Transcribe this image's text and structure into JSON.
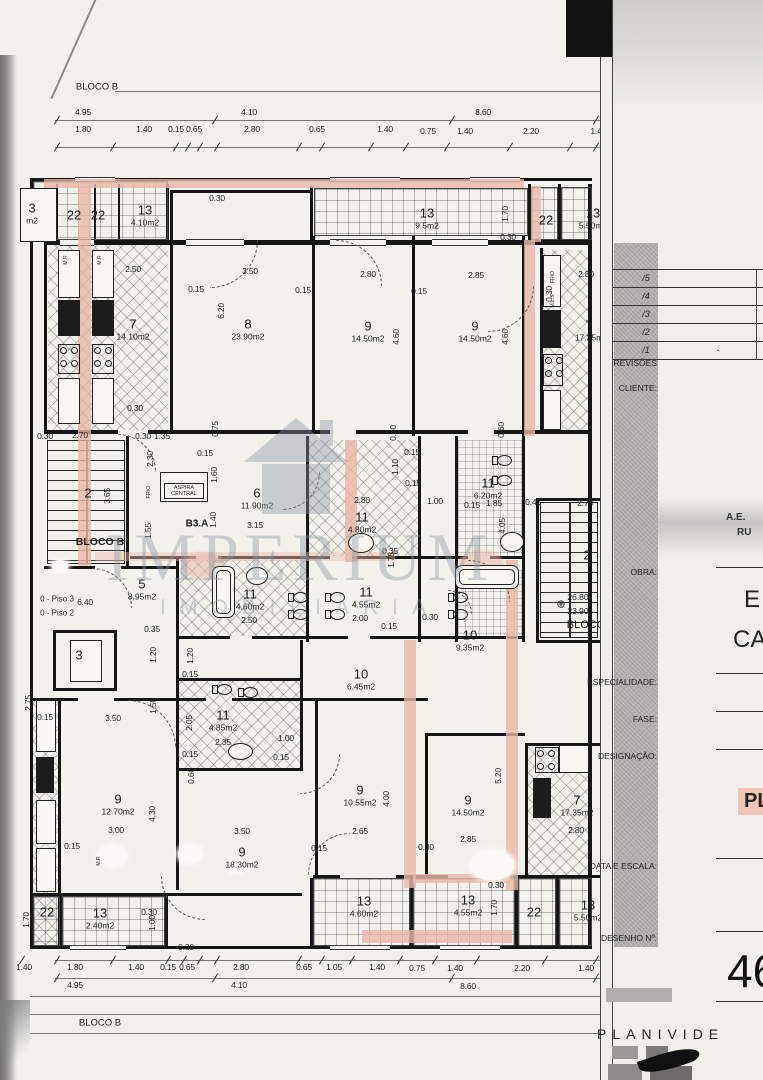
{
  "page": {
    "bloco_label_top": "BLOCO B",
    "bloco_label_bottom": "BLOCO B"
  },
  "watermark": {
    "brand": "IMPERIUM",
    "tagline": "IMOBILIÁRIA"
  },
  "colors": {
    "wall_highlight": "#e8b7a6",
    "designation_highlight": "#f2c6b6",
    "paper": "#f2f1ec",
    "ink": "#1b1b1b"
  },
  "plan": {
    "dim_labels": [
      {
        "t": "4.95",
        "x": 83,
        "y": 112
      },
      {
        "t": "4.10",
        "x": 249,
        "y": 112
      },
      {
        "t": "8.60",
        "x": 483,
        "y": 112
      },
      {
        "t": "1.80",
        "x": 83,
        "y": 129
      },
      {
        "t": "1.40",
        "x": 144,
        "y": 129
      },
      {
        "t": "0.15",
        "x": 176,
        "y": 129
      },
      {
        "t": "0.65",
        "x": 194,
        "y": 129
      },
      {
        "t": "2.80",
        "x": 252,
        "y": 129
      },
      {
        "t": "0.65",
        "x": 317,
        "y": 129
      },
      {
        "t": "1.40",
        "x": 385,
        "y": 129
      },
      {
        "t": "0.75",
        "x": 428,
        "y": 131
      },
      {
        "t": "1.40",
        "x": 465,
        "y": 131
      },
      {
        "t": "2.20",
        "x": 531,
        "y": 131
      },
      {
        "t": "1.4",
        "x": 596,
        "y": 131
      },
      {
        "t": "0.30",
        "x": 217,
        "y": 198
      },
      {
        "t": "1.70",
        "x": 505,
        "y": 214,
        "v": 1
      },
      {
        "t": "0.30",
        "x": 508,
        "y": 237
      },
      {
        "t": "2.50",
        "x": 133,
        "y": 269
      },
      {
        "t": "3.50",
        "x": 250,
        "y": 271
      },
      {
        "t": "0.15",
        "x": 196,
        "y": 289
      },
      {
        "t": "6.20",
        "x": 221,
        "y": 311,
        "v": 1
      },
      {
        "t": "0.30",
        "x": 135,
        "y": 408
      },
      {
        "t": "2.80",
        "x": 368,
        "y": 274
      },
      {
        "t": "0.15",
        "x": 303,
        "y": 290
      },
      {
        "t": "4.60",
        "x": 396,
        "y": 337,
        "v": 1
      },
      {
        "t": "2.85",
        "x": 476,
        "y": 275
      },
      {
        "t": "0.15",
        "x": 419,
        "y": 291
      },
      {
        "t": "4.60",
        "x": 505,
        "y": 337,
        "v": 1
      },
      {
        "t": "2.80",
        "x": 586,
        "y": 274
      },
      {
        "t": "0.30",
        "x": 549,
        "y": 294,
        "v": 1
      },
      {
        "t": "0.30",
        "x": 45,
        "y": 436
      },
      {
        "t": "2.70",
        "x": 80,
        "y": 435
      },
      {
        "t": "0.30",
        "x": 143,
        "y": 436
      },
      {
        "t": "1.35",
        "x": 162,
        "y": 436
      },
      {
        "t": "0.75",
        "x": 215,
        "y": 429,
        "v": 1
      },
      {
        "t": "0.60",
        "x": 393,
        "y": 433,
        "v": 1
      },
      {
        "t": "0.60",
        "x": 501,
        "y": 430,
        "v": 1
      },
      {
        "t": "0.15",
        "x": 205,
        "y": 453
      },
      {
        "t": "2.30",
        "x": 150,
        "y": 459,
        "v": 1
      },
      {
        "t": "1.60",
        "x": 214,
        "y": 475,
        "v": 1
      },
      {
        "t": "3.65",
        "x": 107,
        "y": 496,
        "v": 1
      },
      {
        "t": "0.15",
        "x": 412,
        "y": 452
      },
      {
        "t": "1.10",
        "x": 395,
        "y": 467,
        "v": 1
      },
      {
        "t": "0.15",
        "x": 413,
        "y": 483
      },
      {
        "t": "2.80",
        "x": 362,
        "y": 500
      },
      {
        "t": "1.00",
        "x": 435,
        "y": 501
      },
      {
        "t": "0.15",
        "x": 472,
        "y": 505
      },
      {
        "t": "1.85",
        "x": 494,
        "y": 503
      },
      {
        "t": "4.05",
        "x": 502,
        "y": 526,
        "v": 1
      },
      {
        "t": "0.45",
        "x": 533,
        "y": 502
      },
      {
        "t": "2.70",
        "x": 585,
        "y": 503
      },
      {
        "t": "3.15",
        "x": 255,
        "y": 525
      },
      {
        "t": "1.40",
        "x": 213,
        "y": 520,
        "v": 1
      },
      {
        "t": "1.55",
        "x": 148,
        "y": 531,
        "v": 1
      },
      {
        "t": "1.75",
        "x": 391,
        "y": 560,
        "v": 1
      },
      {
        "t": "0.35",
        "x": 390,
        "y": 551
      },
      {
        "t": "6.40",
        "x": 85,
        "y": 602
      },
      {
        "t": "0.35",
        "x": 152,
        "y": 629
      },
      {
        "t": "0.30",
        "x": 430,
        "y": 617
      },
      {
        "t": "0.15",
        "x": 389,
        "y": 626
      },
      {
        "t": "2.50",
        "x": 249,
        "y": 620
      },
      {
        "t": "2.00",
        "x": 360,
        "y": 618
      },
      {
        "t": "1.20",
        "x": 153,
        "y": 655,
        "v": 1
      },
      {
        "t": "1.20",
        "x": 190,
        "y": 656,
        "v": 1
      },
      {
        "t": "0.15",
        "x": 190,
        "y": 674
      },
      {
        "t": "1.50",
        "x": 153,
        "y": 706,
        "v": 1
      },
      {
        "t": "3.50",
        "x": 113,
        "y": 718
      },
      {
        "t": "2.05",
        "x": 189,
        "y": 723,
        "v": 1
      },
      {
        "t": "2.35",
        "x": 223,
        "y": 742
      },
      {
        "t": "1.00",
        "x": 286,
        "y": 738
      },
      {
        "t": "0.15",
        "x": 190,
        "y": 754
      },
      {
        "t": "0.15",
        "x": 281,
        "y": 757
      },
      {
        "t": "0.60",
        "x": 191,
        "y": 776,
        "v": 1
      },
      {
        "t": "2.75",
        "x": 28,
        "y": 703,
        "v": 1
      },
      {
        "t": "0.15",
        "x": 45,
        "y": 717
      },
      {
        "t": "3.00",
        "x": 116,
        "y": 830
      },
      {
        "t": "4.30",
        "x": 152,
        "y": 814,
        "v": 1
      },
      {
        "t": "0.15",
        "x": 72,
        "y": 846
      },
      {
        "t": "3.50",
        "x": 242,
        "y": 831
      },
      {
        "t": "2.65",
        "x": 360,
        "y": 831
      },
      {
        "t": "4.00",
        "x": 386,
        "y": 799,
        "v": 1
      },
      {
        "t": "0.15",
        "x": 319,
        "y": 848
      },
      {
        "t": "0.30",
        "x": 426,
        "y": 847
      },
      {
        "t": "2.85",
        "x": 468,
        "y": 839
      },
      {
        "t": "5.20",
        "x": 498,
        "y": 776,
        "v": 1
      },
      {
        "t": "2.80",
        "x": 576,
        "y": 830
      },
      {
        "t": "0.30",
        "x": 496,
        "y": 885
      },
      {
        "t": "1.70",
        "x": 494,
        "y": 908,
        "v": 1
      },
      {
        "t": "0.30",
        "x": 149,
        "y": 912
      },
      {
        "t": "1.00",
        "x": 152,
        "y": 923,
        "v": 1
      },
      {
        "t": "1.70",
        "x": 26,
        "y": 920,
        "v": 1
      },
      {
        "t": "0.30",
        "x": 186,
        "y": 947
      },
      {
        "t": "1.40",
        "x": 24,
        "y": 967
      },
      {
        "t": "1.80",
        "x": 75,
        "y": 967
      },
      {
        "t": "1.40",
        "x": 136,
        "y": 967
      },
      {
        "t": "0.15",
        "x": 168,
        "y": 967
      },
      {
        "t": "0.65",
        "x": 187,
        "y": 967
      },
      {
        "t": "2.80",
        "x": 241,
        "y": 967
      },
      {
        "t": "0.65",
        "x": 304,
        "y": 967
      },
      {
        "t": "1.05",
        "x": 334,
        "y": 967
      },
      {
        "t": "1.40",
        "x": 377,
        "y": 967
      },
      {
        "t": "0.75",
        "x": 417,
        "y": 968
      },
      {
        "t": "1.40",
        "x": 455,
        "y": 968
      },
      {
        "t": "2.20",
        "x": 522,
        "y": 968
      },
      {
        "t": "1.40",
        "x": 586,
        "y": 968
      },
      {
        "t": "4.95",
        "x": 75,
        "y": 985
      },
      {
        "t": "4.10",
        "x": 239,
        "y": 985
      },
      {
        "t": "8.60",
        "x": 468,
        "y": 986
      }
    ],
    "room_labels": [
      {
        "num": "3",
        "area": "m2",
        "x": 32,
        "y": 214
      },
      {
        "num": "22",
        "x": 74,
        "y": 216
      },
      {
        "num": "22",
        "x": 98,
        "y": 216
      },
      {
        "num": "13",
        "area": "4.10m2",
        "x": 145,
        "y": 216
      },
      {
        "num": "13",
        "area": "9.5m2",
        "x": 427,
        "y": 219
      },
      {
        "num": "22",
        "x": 546,
        "y": 221
      },
      {
        "num": "13",
        "area": "5.50m2",
        "x": 593,
        "y": 219
      },
      {
        "num": "7",
        "area": "14.10m2",
        "x": 133,
        "y": 330
      },
      {
        "num": "8",
        "area": "23.90m2",
        "x": 248,
        "y": 330
      },
      {
        "num": "9",
        "area": "14.50m2",
        "x": 368,
        "y": 332
      },
      {
        "num": "9",
        "area": "14.50m2",
        "x": 475,
        "y": 332
      },
      {
        "num": "7",
        "area": "17.35m",
        "x": 589,
        "y": 331
      },
      {
        "num": "2",
        "x": 88,
        "y": 494
      },
      {
        "num": "6",
        "area": "11.90m2",
        "x": 257,
        "y": 499
      },
      {
        "num": "11",
        "area": "4.80m2",
        "x": 362,
        "y": 523
      },
      {
        "num": "11",
        "area": "6.20m2",
        "x": 488,
        "y": 489
      },
      {
        "num": "5",
        "area": "8.95m2",
        "x": 142,
        "y": 590
      },
      {
        "num": "11",
        "area": "4.60m2",
        "x": 250,
        "y": 600
      },
      {
        "num": "11",
        "area": "4.55m2",
        "x": 366,
        "y": 598
      },
      {
        "num": "10",
        "area": "9.35m2",
        "x": 470,
        "y": 641
      },
      {
        "num": "10",
        "area": "6.45m2",
        "x": 361,
        "y": 680
      },
      {
        "num": "2",
        "x": 587,
        "y": 556
      },
      {
        "num": "3",
        "x": 79,
        "y": 656
      },
      {
        "num": "11",
        "area": "4.85m2",
        "x": 223,
        "y": 721
      },
      {
        "num": "9",
        "area": "12.70m2",
        "x": 118,
        "y": 805
      },
      {
        "num": "9",
        "area": "18.30m2",
        "x": 242,
        "y": 858
      },
      {
        "num": "9",
        "area": "10.55m2",
        "x": 360,
        "y": 796
      },
      {
        "num": "9",
        "area": "14.50m2",
        "x": 468,
        "y": 806
      },
      {
        "num": "7",
        "area": "17.35m2",
        "x": 577,
        "y": 806
      },
      {
        "num": "13",
        "area": "4.60m2",
        "x": 364,
        "y": 907
      },
      {
        "num": "13",
        "area": "4.55m2",
        "x": 468,
        "y": 906
      },
      {
        "num": "22",
        "x": 534,
        "y": 913
      },
      {
        "num": "13",
        "area": "5.50m2",
        "x": 588,
        "y": 911
      },
      {
        "num": "22",
        "x": 47,
        "y": 913
      },
      {
        "num": "13",
        "area": "2.40m2",
        "x": 100,
        "y": 919
      }
    ],
    "text_labels": [
      {
        "t": "BLOCO B",
        "x": 100,
        "y": 542,
        "s": 10.5,
        "b": 1
      },
      {
        "t": "0 - Piso 3",
        "x": 57,
        "y": 599,
        "s": 8
      },
      {
        "t": "0 - Piso 2",
        "x": 57,
        "y": 613,
        "s": 8
      },
      {
        "t": "B3.A",
        "x": 197,
        "y": 524,
        "s": 10,
        "b": 1
      },
      {
        "t": "FRIO",
        "x": 149,
        "y": 492,
        "s": 5.5,
        "v": 1
      },
      {
        "t": "ASPIRA CENTRAL",
        "x": 184,
        "y": 491,
        "s": 5.5,
        "w": 38
      },
      {
        "t": "26.80",
        "x": 578,
        "y": 597,
        "s": 8.5
      },
      {
        "t": "23.90",
        "x": 578,
        "y": 611,
        "s": 8.5
      },
      {
        "t": "BLOCO",
        "x": 586,
        "y": 625,
        "s": 11
      },
      {
        "t": "⊕",
        "x": 561,
        "y": 604,
        "s": 11
      },
      {
        "t": "M.R",
        "x": 66,
        "y": 260,
        "s": 5,
        "v": 1
      },
      {
        "t": "M.R",
        "x": 100,
        "y": 260,
        "s": 5,
        "v": 1
      },
      {
        "t": "M.L.R",
        "x": 66,
        "y": 318,
        "s": 5,
        "v": 1
      },
      {
        "t": "M.L.R",
        "x": 100,
        "y": 318,
        "s": 5,
        "v": 1
      },
      {
        "t": "FRIO",
        "x": 553,
        "y": 277,
        "s": 5,
        "v": 1
      },
      {
        "t": "M.L.S",
        "x": 553,
        "y": 301,
        "s": 5,
        "v": 1
      },
      {
        "t": "M.R",
        "x": 99,
        "y": 861,
        "s": 5,
        "v": 1
      }
    ]
  },
  "titleblock": {
    "revisions": [
      "/5",
      "/4",
      "/3",
      "/2",
      "/1"
    ],
    "revision_empty": "-",
    "label_revisions": "REVISÕES",
    "label_client": "CLIENTE:",
    "label_work": "OBRA:",
    "label_specialty": "ESPECIALIDADE:",
    "label_phase": "FASE:",
    "label_designation": "DESIGNAÇÃO:",
    "label_date_scale": "DATA E ESCALA:",
    "label_drawing_no": "DESENHO Nº:",
    "client_line1": "A.E.",
    "client_line2": "RU",
    "work_line1": "E",
    "work_line2": "CA",
    "designation_value": "PL",
    "drawing_no_value": "46",
    "logo_text": "PLANIVIDE"
  }
}
